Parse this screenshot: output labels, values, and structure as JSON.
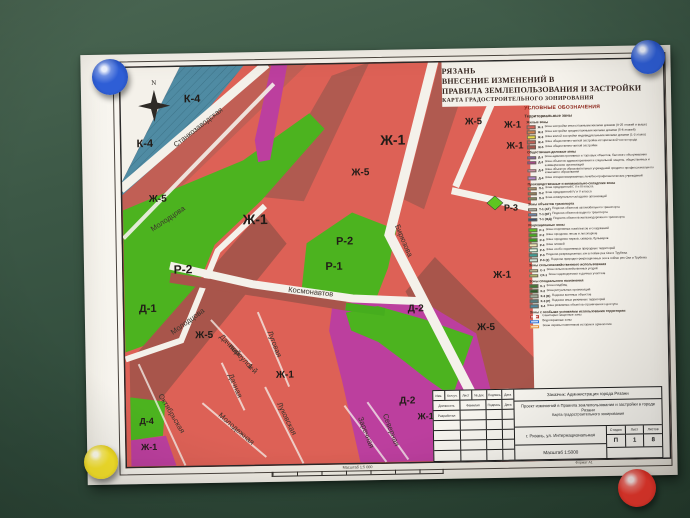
{
  "colors": {
    "paper": "#f4f1ea",
    "board": "#36543f",
    "frame": "#2b2b2b",
    "road": "#f4f1ea",
    "zh1": "#dd6156",
    "zh5": "#a8554b",
    "band": "#c15f55",
    "dark_band": "#b05a50",
    "green": "#4cb31f",
    "green_bright": "#5ec621",
    "magenta": "#bc3f9e",
    "teal": "#4f8ba3",
    "teal_hatch": "#2f6073"
  },
  "magnets": [
    {
      "name": "blue-magnet-top-left",
      "color": "#2e5ed6",
      "dark": "#1c3f9e"
    },
    {
      "name": "blue-magnet-top-right",
      "color": "#2e5ed6",
      "dark": "#1c3f9e"
    },
    {
      "name": "yellow-magnet-bottom-left",
      "color": "#f7e32b",
      "dark": "#cbb50e"
    },
    {
      "name": "red-magnet-bottom-right",
      "color": "#f63b2f",
      "dark": "#c21f17"
    }
  ],
  "title": {
    "lines": [
      "РЯЗАНЬ",
      "ВНЕСЕНИЕ ИЗМЕНЕНИЙ В",
      "ПРАВИЛА ЗЕМЛЕПОЛЬЗОВАНИЯ И ЗАСТРОЙКИ",
      "КАРТА ГРАДОСТРОИТЕЛЬНОГО ЗОНИРОВАНИЯ"
    ]
  },
  "compass": {
    "north_label": "N"
  },
  "map": {
    "zone_labels": [
      {
        "t": "К-4",
        "x": 73,
        "y": 37,
        "s": 11
      },
      {
        "t": "К-4",
        "x": 25,
        "y": 81,
        "s": 11
      },
      {
        "t": "Ж-5",
        "x": 37,
        "y": 136,
        "s": 10
      },
      {
        "t": "Ж-1",
        "x": 134,
        "y": 160,
        "s": 14
      },
      {
        "t": "Р-2",
        "x": 61,
        "y": 208,
        "s": 12
      },
      {
        "t": "Д-1",
        "x": 25,
        "y": 246,
        "s": 11
      },
      {
        "t": "Ж-5",
        "x": 81,
        "y": 273,
        "s": 10
      },
      {
        "t": "Ж-1",
        "x": 161,
        "y": 314,
        "s": 10
      },
      {
        "t": "Д-4",
        "x": 22,
        "y": 358,
        "s": 9
      },
      {
        "t": "Ж-1",
        "x": 24,
        "y": 384,
        "s": 9
      },
      {
        "t": "Ж-1",
        "x": 273,
        "y": 83,
        "s": 14
      },
      {
        "t": "Ж-5",
        "x": 240,
        "y": 113,
        "s": 10
      },
      {
        "t": "Р-2",
        "x": 223,
        "y": 182,
        "s": 11
      },
      {
        "t": "Р-1",
        "x": 212,
        "y": 207,
        "s": 11
      },
      {
        "t": "Ж-5",
        "x": 354,
        "y": 64,
        "s": 9.5
      },
      {
        "t": "Ж-1",
        "x": 393,
        "y": 68,
        "s": 9.5
      },
      {
        "t": "Ж-1",
        "x": 395,
        "y": 89,
        "s": 9.5
      },
      {
        "t": "Р-3",
        "x": 390,
        "y": 151,
        "s": 9
      },
      {
        "t": "Ж-1",
        "x": 380,
        "y": 218,
        "s": 10
      },
      {
        "t": "Ж-5",
        "x": 363,
        "y": 270,
        "s": 10
      },
      {
        "t": "Д-2",
        "x": 293,
        "y": 250,
        "s": 10
      },
      {
        "t": "Д-2",
        "x": 283,
        "y": 342,
        "s": 10
      },
      {
        "t": "Ж-1",
        "x": 301,
        "y": 358,
        "s": 9
      }
    ],
    "street_labels": [
      {
        "t": "Станкозаводская",
        "x": 80,
        "y": 64,
        "r": -37
      },
      {
        "t": "Молодцова",
        "x": 48,
        "y": 155,
        "r": -33
      },
      {
        "t": "Молодцова",
        "x": 66,
        "y": 258,
        "r": -35
      },
      {
        "t": "Космонавтов",
        "x": 188,
        "y": 231,
        "r": 7
      },
      {
        "t": "Бирюзова",
        "x": 280,
        "y": 180,
        "r": 68
      },
      {
        "t": "Октябрьская",
        "x": 45,
        "y": 349,
        "r": 60
      },
      {
        "t": "Дачный",
        "x": 105,
        "y": 282,
        "r": 47
      },
      {
        "t": "переулок",
        "x": 116,
        "y": 294,
        "r": 47
      },
      {
        "t": "1-й",
        "x": 127,
        "y": 306,
        "r": 47
      },
      {
        "t": "Дачная",
        "x": 109,
        "y": 322,
        "r": 68
      },
      {
        "t": "Луговая",
        "x": 149,
        "y": 281,
        "r": 70
      },
      {
        "t": "Молодежная",
        "x": 110,
        "y": 366,
        "r": 42
      },
      {
        "t": "Луковская",
        "x": 160,
        "y": 356,
        "r": 65
      },
      {
        "t": "Заречная",
        "x": 239,
        "y": 371,
        "r": 70
      },
      {
        "t": "Северная",
        "x": 264,
        "y": 369,
        "r": 70
      }
    ]
  },
  "legend": {
    "title": "УСЛОВНЫЕ ОБОЗНАЧЕНИЯ",
    "subtitle": "Территориальные зоны",
    "sections": [
      {
        "header": "Жилые зоны",
        "items": [
          {
            "code": "Ж-1",
            "label": "Зона застройки многоэтажными жилыми домами (9-25 этажей и выше)",
            "color": "#dd6156"
          },
          {
            "code": "Ж-2",
            "label": "Зона застройки среднеэтажными жилыми домами (5-8 этажей)",
            "color": "#d4804e"
          },
          {
            "code": "Ж-3",
            "label": "Зона жилой застройки индивидуальными жилыми домами (1-3 этажа)",
            "color": "#e9da45"
          },
          {
            "code": "Ж-4",
            "label": "Зона общественно-жилой застройки исторической части города",
            "color": "#c46055"
          },
          {
            "code": "Ж-5",
            "label": "Зона общественно-жилой застройки",
            "color": "#a8554b"
          }
        ]
      },
      {
        "header": "Общественно-деловые зоны",
        "items": [
          {
            "code": "Д-1",
            "label": "Зона административных и торговых объектов, бытового обслуживания",
            "color": "#8f68b5"
          },
          {
            "code": "Д-2",
            "label": "Зона объектов здравоохранения и социальной защиты, общественных и коммерческих организаций",
            "color": "#bc3f9e"
          },
          {
            "code": "Д-3",
            "label": "Зона объектов образовательных учреждений среднего профессионального и высшего образования",
            "color": "#e89cbe"
          },
          {
            "code": "Д-4",
            "label": "Зона специализированных лечебно-профилактических учреждений",
            "color": "#b286c8"
          }
        ]
      },
      {
        "header": "Производственные и коммунально-складские зоны",
        "items": [
          {
            "code": "П-1",
            "label": "Зона предприятий I, II и III класса",
            "color": "#bda379"
          },
          {
            "code": "П-2",
            "label": "Зона предприятий IV и V класса",
            "color": "#a38c5c"
          },
          {
            "code": "П-3",
            "label": "Зона коммунально-складских организаций",
            "color": "#8f9a68"
          }
        ]
      },
      {
        "header": "Зоны объектов транспорта",
        "items": [
          {
            "code": "Т-1 (АТ)",
            "label": "Подзона объектов автомобильного транспорта",
            "color": "#c9c9c0"
          },
          {
            "code": "Т-1 (ВТ)",
            "label": "Подзона объектов водного транспорта",
            "color": "#7090c8"
          },
          {
            "code": "Т-1 (ЖД)",
            "label": "Подзона объектов железнодорожного транспорта",
            "color": "#2e4878"
          }
        ]
      },
      {
        "header": "Рекреационные зоны",
        "items": [
          {
            "code": "Р-1",
            "label": "Зона спортивных комплексов и сооружений",
            "color": "#5ec621"
          },
          {
            "code": "Р-2",
            "label": "Зона городских лесов и лесопарков",
            "color": "#46ad1e"
          },
          {
            "code": "Р-3",
            "label": "Зона городских парков, скверов, бульваров",
            "color": "#35a018"
          },
          {
            "code": "Р-4",
            "label": "Зона пляжей",
            "color": "#efe9b6"
          },
          {
            "code": "Р-5",
            "label": "Зона особо охраняемых природных территорий",
            "color": "#eef3e2",
            "swatch": "outline"
          },
          {
            "code": "Р-6",
            "label": "Подзона рекреационных зон в пойме рек Оки и Трубежа",
            "color": "#3f9e96"
          },
          {
            "code": "Р-6 (2)",
            "label": "Подзона природно-рекреационных зон в пойме рек Оки и Трубежа",
            "color": "#cfe3d8"
          }
        ]
      },
      {
        "header": "Зоны сельскохозяйственного использования",
        "items": [
          {
            "code": "С-1",
            "label": "Зона сельскохозяйственных угодий",
            "color": "#d8d2a0"
          },
          {
            "code": "СХ-1",
            "label": "Зона садоводческих и дачных участков",
            "color": "#cbd96e"
          }
        ]
      },
      {
        "header": "Зоны специального назначения",
        "items": [
          {
            "code": "К-1",
            "label": "Зона кладбищ",
            "color": "#3f7a35"
          },
          {
            "code": "К-2",
            "label": "Зона ритуальных организаций",
            "color": "#2e5c28"
          },
          {
            "code": "К-3 (В)",
            "label": "Подзона военных объектов",
            "color": "#9fae9b"
          },
          {
            "code": "К-3 (Р)",
            "label": "Подзона иных режимных территорий",
            "color": "#547d82"
          },
          {
            "code": "К-4",
            "label": "Зона режимных объектов ограниченного доступа",
            "color": "#4f8ba3"
          }
        ]
      },
      {
        "header": "Зоны с особыми условиями использования территории",
        "items": [
          {
            "code": "",
            "label": "Санитарно-защитные зоны",
            "color": "#ffffff",
            "swatch": "dashed"
          },
          {
            "code": "",
            "label": "Водоохранные зоны",
            "color": "#ffffff",
            "swatch": "line-blue"
          },
          {
            "code": "",
            "label": "Зоны охраны памятников истории и археологии",
            "color": "#ffffff",
            "swatch": "line-orange"
          }
        ]
      }
    ]
  },
  "stamp": {
    "customer": "Заказчик:  Администрация города Рязани",
    "project": "Проект изменений в Правила землепользования и застройки в городе Рязани",
    "doc": "Карта градостроительного зонирования",
    "address": "г. Рязань, ул. Интернациональная",
    "stage_label": "Стадия",
    "sheet_label": "Лист",
    "sheets_label": "Листов",
    "stage": "П",
    "sheet": "1",
    "sheets": "8",
    "scale": "Масштаб 1:5000",
    "cols": [
      "Изм.",
      "Кол.уч.",
      "Лист",
      "№ док.",
      "Подпись",
      "Дата"
    ],
    "row2": [
      "Должность",
      "Фамилия",
      "Подпись",
      "Дата"
    ],
    "row3": "Разработал"
  },
  "scale_bar": {
    "label": "Масштаб 1:5 000"
  },
  "format_note": "Формат А1"
}
